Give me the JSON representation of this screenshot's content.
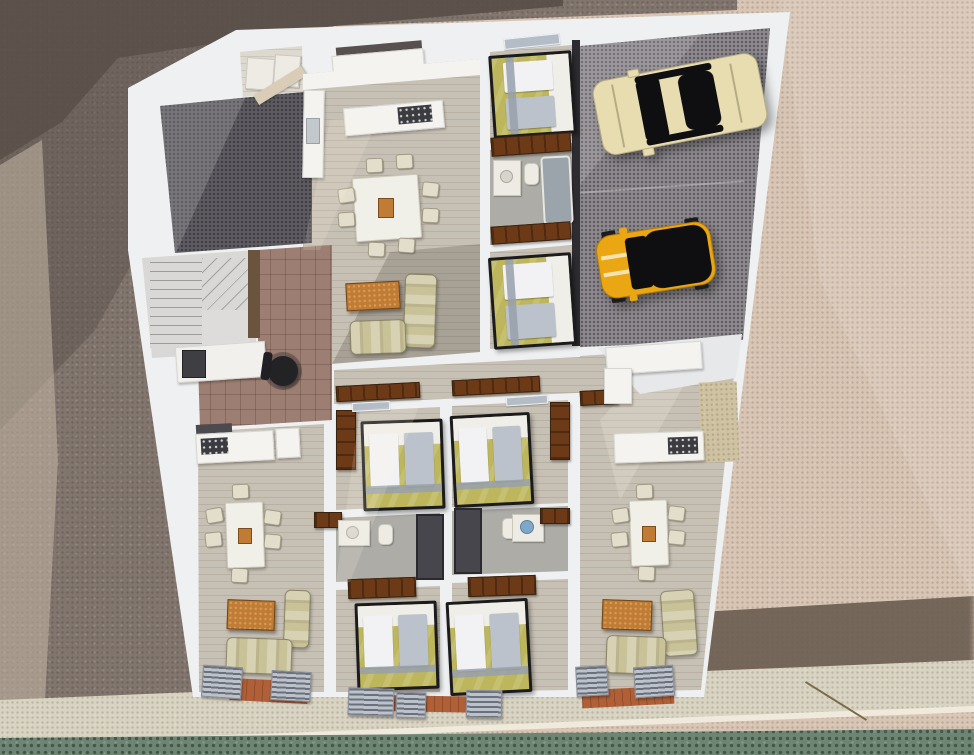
{
  "scene": {
    "type": "3d-floor-plan-render",
    "view": "top-down aerial axonometric",
    "description": "Photorealistic 3D rendering of an apartment building floor: three furnished apartments, four central bedrooms with two shared bathrooms, a winder staircase hall with desk, a dark tiled patio, a two-car garage, perimeter walkway and hedge strip"
  },
  "palette": {
    "ground_left": "#81756d",
    "ground_left_shadow": "#564d47",
    "ground_left_light": "#cdbfae",
    "ground_right": "#d8c5b4",
    "ground_right_shadow": "#6a5c50",
    "walkway": "#d9d3c2",
    "walkway_curb": "#efeadb",
    "hedge": "#6e8574",
    "wall_white": "#eef0f1",
    "wall_shade": "#c6cad1",
    "garage_floor": "#8b878c",
    "garage_threshold": "#2e2c30",
    "wood_floor": "#c7c0b4",
    "wood_floor_warm": "#ded9cf",
    "terrace_dark": "#5d5a60",
    "hall_tile": "#9c7e72",
    "stair_tread": "#d9d8d6",
    "stair_wood": "#6a543e",
    "wardrobe_brown": "#6d3a18",
    "bed_duvet": "#bdb65c",
    "bed_sheet": "#efeee8",
    "pillow_white": "#f2f2f4",
    "pillow_gray": "#bcc2cb",
    "bed_runner": "#97a0ac",
    "sofa_beige": "#c9c197",
    "coffee_table": "#c07c35",
    "dining_table": "#f0efe8",
    "chair_cream": "#e3decb",
    "counter_white": "#f4f3ef",
    "counter_dark": "#4c4a4e",
    "cooktop_dark": "#3b3b40",
    "bath_floor": "#aeaca6",
    "fixture_white": "#eeebe4",
    "tub_gray": "#9ba3ab",
    "shower_dark": "#46464c",
    "sink_bowl_blue": "#7fa8c8",
    "terracotta": "#b05f36",
    "car_cream": "#e7ddb0",
    "car_glass": "#0f0f12",
    "car_yellow": "#eaa613",
    "car_stripe": "#f6eecf",
    "desk_white": "#f1f0ec",
    "office_chair_black": "#232326",
    "niche_dark": "#57504e",
    "twig_brown": "#7a6a4a"
  },
  "environment": {
    "grounds": [
      "granite paving in building shadow (left)",
      "beige gravel forecourt (right)"
    ],
    "perimeter": [
      "stone walkway with white curb",
      "green hedge strip along bottom edge"
    ]
  },
  "building": {
    "garage": {
      "floor": "dark speckled concrete",
      "vehicles": [
        {
          "name": "cream-sedan",
          "body_color_key": "car_cream"
        },
        {
          "name": "yellow-mini-black-roof",
          "body_color_key": "car_yellow"
        }
      ]
    },
    "staircase": "winder staircase with landing",
    "rooms": [
      {
        "name": "top-apartment",
        "furniture": [
          "kitchen counters",
          "cooktop island",
          "dining table with 6 chairs",
          "long sofa",
          "loveseat",
          "wood coffee table",
          "double bedroom",
          "bathroom with vanity, toilet and bathtub",
          "two brown wardrobes"
        ]
      },
      {
        "name": "patio-terrace",
        "furniture": [
          "dark tile deck"
        ]
      },
      {
        "name": "utility-room",
        "furniture": [
          "white appliances",
          "counter"
        ]
      },
      {
        "name": "stair-hall",
        "furniture": [
          "desk",
          "black office chair",
          "terracotta tile floor"
        ]
      },
      {
        "name": "center-bedroom-1",
        "furniture": [
          "double bed",
          "wardrobe"
        ]
      },
      {
        "name": "center-bedroom-2",
        "furniture": [
          "double bed",
          "wardrobe"
        ]
      },
      {
        "name": "center-bedroom-3",
        "furniture": [
          "double bed",
          "wardrobe"
        ]
      },
      {
        "name": "center-bedroom-4",
        "furniture": [
          "double bed",
          "wardrobe"
        ]
      },
      {
        "name": "shared-bathroom-left",
        "furniture": [
          "vanity",
          "toilet",
          "shower"
        ]
      },
      {
        "name": "shared-bathroom-right",
        "furniture": [
          "vanity with blue bowl",
          "toilet",
          "shower"
        ]
      },
      {
        "name": "left-apartment",
        "furniture": [
          "kitchen counter with cooktop",
          "dining table with 6 chairs",
          "sofa",
          "armchair",
          "wood coffee table",
          "louvered balcony shutters"
        ]
      },
      {
        "name": "right-apartment",
        "furniture": [
          "L-shaped kitchen with cooktop",
          "dining table with 6 chairs",
          "two sofas",
          "wood coffee table",
          "louvered balcony shutters"
        ]
      }
    ],
    "bed_count": 6,
    "balconies": "terracotta strips with gray louver shutters along bottom facade"
  }
}
